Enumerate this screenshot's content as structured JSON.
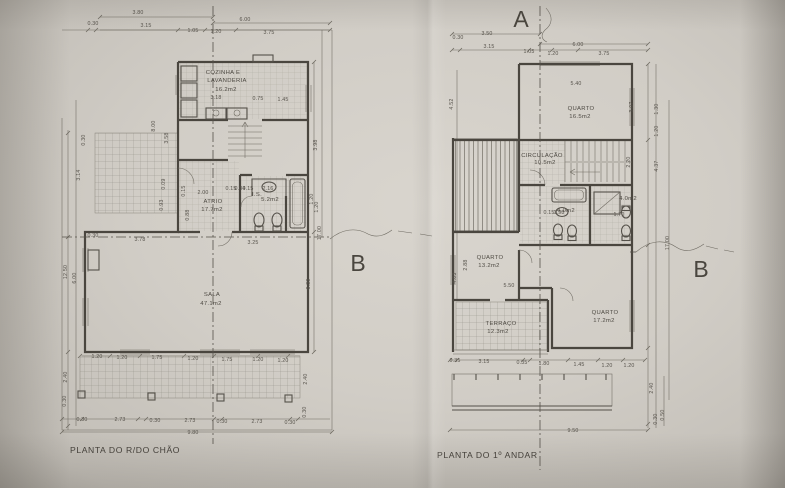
{
  "photo": {
    "paper_color": "#d3cfc8",
    "line_color": "#4a463f",
    "text_color": "#56524b"
  },
  "section_markers": {
    "a": "A",
    "b_ground": "B",
    "b_first": "B"
  },
  "ground_floor": {
    "title": "PLANTA DO R/DO CHÃO",
    "rooms": {
      "cozinha": {
        "line1": "COZINHA E",
        "line2": "LAVANDERIA",
        "area": "16.2m2"
      },
      "atrio": {
        "name": "ATRIO",
        "area": "17.7m2"
      },
      "is": {
        "name": "I.S.",
        "area": "5.2m2"
      },
      "sala": {
        "name": "SALA",
        "area": "47.1m2"
      }
    },
    "dim_labels": [
      {
        "t": "3.80",
        "x": 138,
        "y": 14
      },
      {
        "t": "6.00",
        "x": 245,
        "y": 21
      },
      {
        "t": "0.30",
        "x": 93,
        "y": 25
      },
      {
        "t": "3.15",
        "x": 146,
        "y": 27
      },
      {
        "t": "1.05",
        "x": 193,
        "y": 32
      },
      {
        "t": "1.20",
        "x": 216,
        "y": 33
      },
      {
        "t": "3.75",
        "x": 269,
        "y": 34
      },
      {
        "t": "3.18",
        "x": 216,
        "y": 99
      },
      {
        "t": "0.75",
        "x": 258,
        "y": 100
      },
      {
        "t": "1.45",
        "x": 283,
        "y": 101
      },
      {
        "t": "8.00",
        "x": 155,
        "y": 126,
        "r": -90
      },
      {
        "t": "3.58",
        "x": 168,
        "y": 138,
        "r": -90
      },
      {
        "t": "0.30",
        "x": 85,
        "y": 140,
        "r": -90
      },
      {
        "t": "3.14",
        "x": 80,
        "y": 175,
        "r": -90
      },
      {
        "t": "0.09",
        "x": 165,
        "y": 184,
        "r": -90
      },
      {
        "t": "0.93",
        "x": 163,
        "y": 205,
        "r": -90
      },
      {
        "t": "12.50",
        "x": 67,
        "y": 272,
        "r": -90
      },
      {
        "t": "6.00",
        "x": 76,
        "y": 278,
        "r": -90
      },
      {
        "t": "2.00",
        "x": 203,
        "y": 194
      },
      {
        "t": "0.15",
        "x": 185,
        "y": 191,
        "r": -90
      },
      {
        "t": "0.88",
        "x": 189,
        "y": 215,
        "r": -90
      },
      {
        "t": "0.15",
        "x": 231,
        "y": 190
      },
      {
        "t": "0.84",
        "x": 240,
        "y": 190
      },
      {
        "t": "0.15",
        "x": 248,
        "y": 190
      },
      {
        "t": "2.16",
        "x": 268,
        "y": 190
      },
      {
        "t": "1.20",
        "x": 318,
        "y": 207,
        "r": -90
      },
      {
        "t": "3.98",
        "x": 317,
        "y": 145,
        "r": -90
      },
      {
        "t": "1.20",
        "x": 313,
        "y": 199,
        "r": -90
      },
      {
        "t": "17.00",
        "x": 321,
        "y": 233,
        "r": -90
      },
      {
        "t": "6.39",
        "x": 310,
        "y": 284,
        "r": -90
      },
      {
        "t": "0.30",
        "x": 93,
        "y": 237
      },
      {
        "t": "3.78",
        "x": 140,
        "y": 241
      },
      {
        "t": "3.25",
        "x": 253,
        "y": 244
      },
      {
        "t": "1.20",
        "x": 97,
        "y": 358
      },
      {
        "t": "1.20",
        "x": 122,
        "y": 359
      },
      {
        "t": "1.75",
        "x": 157,
        "y": 359
      },
      {
        "t": "1.20",
        "x": 193,
        "y": 360
      },
      {
        "t": "1.75",
        "x": 227,
        "y": 361
      },
      {
        "t": "1.20",
        "x": 258,
        "y": 361
      },
      {
        "t": "1.20",
        "x": 283,
        "y": 362
      },
      {
        "t": "2.40",
        "x": 67,
        "y": 377,
        "r": -90
      },
      {
        "t": "0.30",
        "x": 66,
        "y": 401,
        "r": -90
      },
      {
        "t": "2.40",
        "x": 307,
        "y": 379,
        "r": -90
      },
      {
        "t": "0.30",
        "x": 306,
        "y": 412,
        "r": -90
      },
      {
        "t": "0.30",
        "x": 82,
        "y": 421
      },
      {
        "t": "2.73",
        "x": 120,
        "y": 421
      },
      {
        "t": "0.30",
        "x": 155,
        "y": 422
      },
      {
        "t": "2.73",
        "x": 190,
        "y": 422
      },
      {
        "t": "0.30",
        "x": 222,
        "y": 423
      },
      {
        "t": "2.73",
        "x": 257,
        "y": 423
      },
      {
        "t": "0.30",
        "x": 290,
        "y": 424
      },
      {
        "t": "9.80",
        "x": 193,
        "y": 434
      }
    ]
  },
  "first_floor": {
    "title": "PLANTA DO 1º ANDAR",
    "rooms": {
      "quarto_norte": {
        "name": "QUARTO",
        "area": "16.5m2"
      },
      "circulacao": {
        "name": "CIRCULAÇÃO",
        "area": "10.5m2"
      },
      "is_1": {
        "area": "4.0m2"
      },
      "is_2": {
        "area": "4.0m2"
      },
      "quarto_oeste": {
        "name": "QUARTO",
        "area": "13.2m2"
      },
      "quarto_sul": {
        "name": "QUARTO",
        "area": "17.2m2"
      },
      "terraco": {
        "name": "TERRAÇO",
        "area": "12.3m2"
      }
    },
    "dim_labels": [
      {
        "t": "3.50",
        "x": 487,
        "y": 35
      },
      {
        "t": "6.00",
        "x": 578,
        "y": 46
      },
      {
        "t": "0.30",
        "x": 458,
        "y": 39
      },
      {
        "t": "3.15",
        "x": 489,
        "y": 48
      },
      {
        "t": "1.05",
        "x": 529,
        "y": 53
      },
      {
        "t": "1.20",
        "x": 553,
        "y": 55
      },
      {
        "t": "3.75",
        "x": 604,
        "y": 55
      },
      {
        "t": "5.40",
        "x": 576,
        "y": 85
      },
      {
        "t": "3.07",
        "x": 633,
        "y": 107,
        "r": -90
      },
      {
        "t": "1.30",
        "x": 658,
        "y": 109,
        "r": -90
      },
      {
        "t": "1.20",
        "x": 658,
        "y": 131,
        "r": -90
      },
      {
        "t": "2.20",
        "x": 630,
        "y": 162,
        "r": -90
      },
      {
        "t": "4.37",
        "x": 658,
        "y": 166,
        "r": -90
      },
      {
        "t": "17.00",
        "x": 669,
        "y": 243,
        "r": -90
      },
      {
        "t": "4.52",
        "x": 453,
        "y": 104,
        "r": -90
      },
      {
        "t": "2.88",
        "x": 467,
        "y": 265,
        "r": -90
      },
      {
        "t": "4.03",
        "x": 456,
        "y": 278,
        "r": -90
      },
      {
        "t": "0.15",
        "x": 549,
        "y": 214
      },
      {
        "t": "1.98",
        "x": 559,
        "y": 214
      },
      {
        "t": "1.70",
        "x": 619,
        "y": 216
      },
      {
        "t": "5.50",
        "x": 509,
        "y": 287
      },
      {
        "t": "0.35",
        "x": 455,
        "y": 362
      },
      {
        "t": "3.15",
        "x": 484,
        "y": 363
      },
      {
        "t": "0.35",
        "x": 522,
        "y": 364
      },
      {
        "t": "1.80",
        "x": 544,
        "y": 365
      },
      {
        "t": "1.45",
        "x": 579,
        "y": 366
      },
      {
        "t": "1.20",
        "x": 607,
        "y": 367
      },
      {
        "t": "1.20",
        "x": 629,
        "y": 367
      },
      {
        "t": "2.40",
        "x": 653,
        "y": 388,
        "r": -90
      },
      {
        "t": "0.50",
        "x": 664,
        "y": 415,
        "r": -90
      },
      {
        "t": "0.30",
        "x": 657,
        "y": 419,
        "r": -90
      },
      {
        "t": "9.50",
        "x": 573,
        "y": 432
      }
    ]
  }
}
